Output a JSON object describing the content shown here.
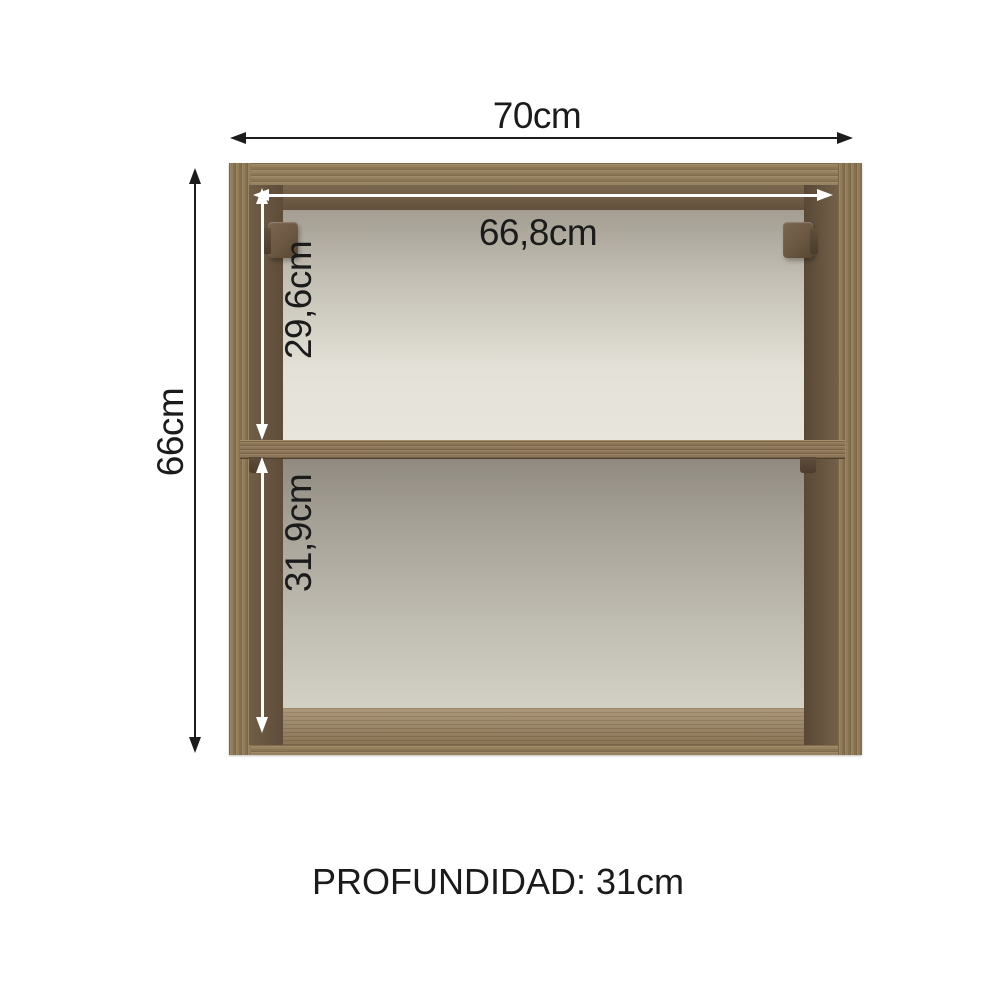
{
  "diagram": {
    "title": "cabinet-dimension-diagram",
    "product": "open wall cabinet with one middle shelf, two hinges, no doors",
    "labels": {
      "width_total": "70cm",
      "height_total": "66cm",
      "inner_width": "66,8cm",
      "upper_compartment_height": "29,6cm",
      "lower_compartment_height": "31,9cm",
      "depth": "PROFUNDIDAD: 31cm"
    },
    "dimensions": {
      "width_total_cm": 70,
      "height_total_cm": 66,
      "inner_width_cm": 66.8,
      "upper_compartment_height_cm": 29.6,
      "lower_compartment_height_cm": 31.9,
      "depth_cm": 31
    },
    "colors": {
      "wood_light": "#97825f",
      "wood_inner_dark": "#6b5946",
      "back_panel_light": "#e6e4da",
      "back_panel_shadow": "#a09a8f",
      "hinge_brown": "#6b5742",
      "arrow_black": "#1c1c1c",
      "arrow_white": "#ffffff",
      "background": "#ffffff",
      "text": "#1b1b1b"
    }
  }
}
